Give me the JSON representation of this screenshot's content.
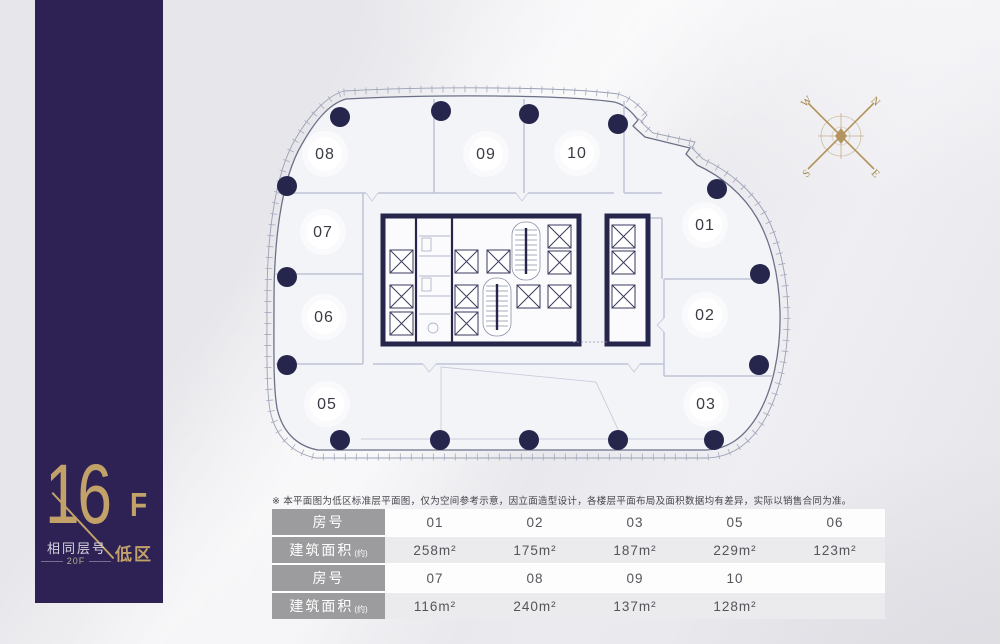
{
  "colors": {
    "band_purple": "#2d2253",
    "gold": "#c3a269",
    "navy": "#26264c",
    "label_gray": "#9c9c9e"
  },
  "floor_badge": {
    "number": "16",
    "suffix": "F",
    "same_floor_label": "相同层号",
    "same_floor_value": "20F",
    "zone": "低区"
  },
  "compass": {
    "n": "N",
    "e": "E",
    "s": "S",
    "w": "W"
  },
  "plan": {
    "rooms": [
      {
        "id": "08",
        "x": 59,
        "y": 68
      },
      {
        "id": "09",
        "x": 220,
        "y": 68
      },
      {
        "id": "10",
        "x": 311,
        "y": 67
      },
      {
        "id": "07",
        "x": 57,
        "y": 146
      },
      {
        "id": "01",
        "x": 439,
        "y": 139
      },
      {
        "id": "06",
        "x": 58,
        "y": 231
      },
      {
        "id": "02",
        "x": 439,
        "y": 229
      },
      {
        "id": "05",
        "x": 61,
        "y": 318
      },
      {
        "id": "03",
        "x": 440,
        "y": 318
      }
    ],
    "columns": [
      [
        74,
        31
      ],
      [
        175,
        25
      ],
      [
        263,
        28
      ],
      [
        352,
        38
      ],
      [
        21,
        100
      ],
      [
        451,
        103
      ],
      [
        21,
        191
      ],
      [
        494,
        188
      ],
      [
        21,
        279
      ],
      [
        493,
        279
      ],
      [
        74,
        354
      ],
      [
        174,
        354
      ],
      [
        263,
        354
      ],
      [
        352,
        354
      ],
      [
        448,
        354
      ]
    ]
  },
  "disclaimer": "※ 本平面图为低区标准层平面图，仅为空间参考示意，因立面造型设计，各楼层平面布局及面积数据均有差异，实际以销售合同为准。",
  "table": {
    "room_label": "房号",
    "area_label": "建筑面积",
    "area_note": "(约)",
    "groups": [
      {
        "rooms": [
          "01",
          "02",
          "03",
          "05",
          "06"
        ],
        "areas": [
          "258m²",
          "175m²",
          "187m²",
          "229m²",
          "123m²"
        ]
      },
      {
        "rooms": [
          "07",
          "08",
          "09",
          "10",
          ""
        ],
        "areas": [
          "116m²",
          "240m²",
          "137m²",
          "128m²",
          ""
        ]
      }
    ]
  }
}
